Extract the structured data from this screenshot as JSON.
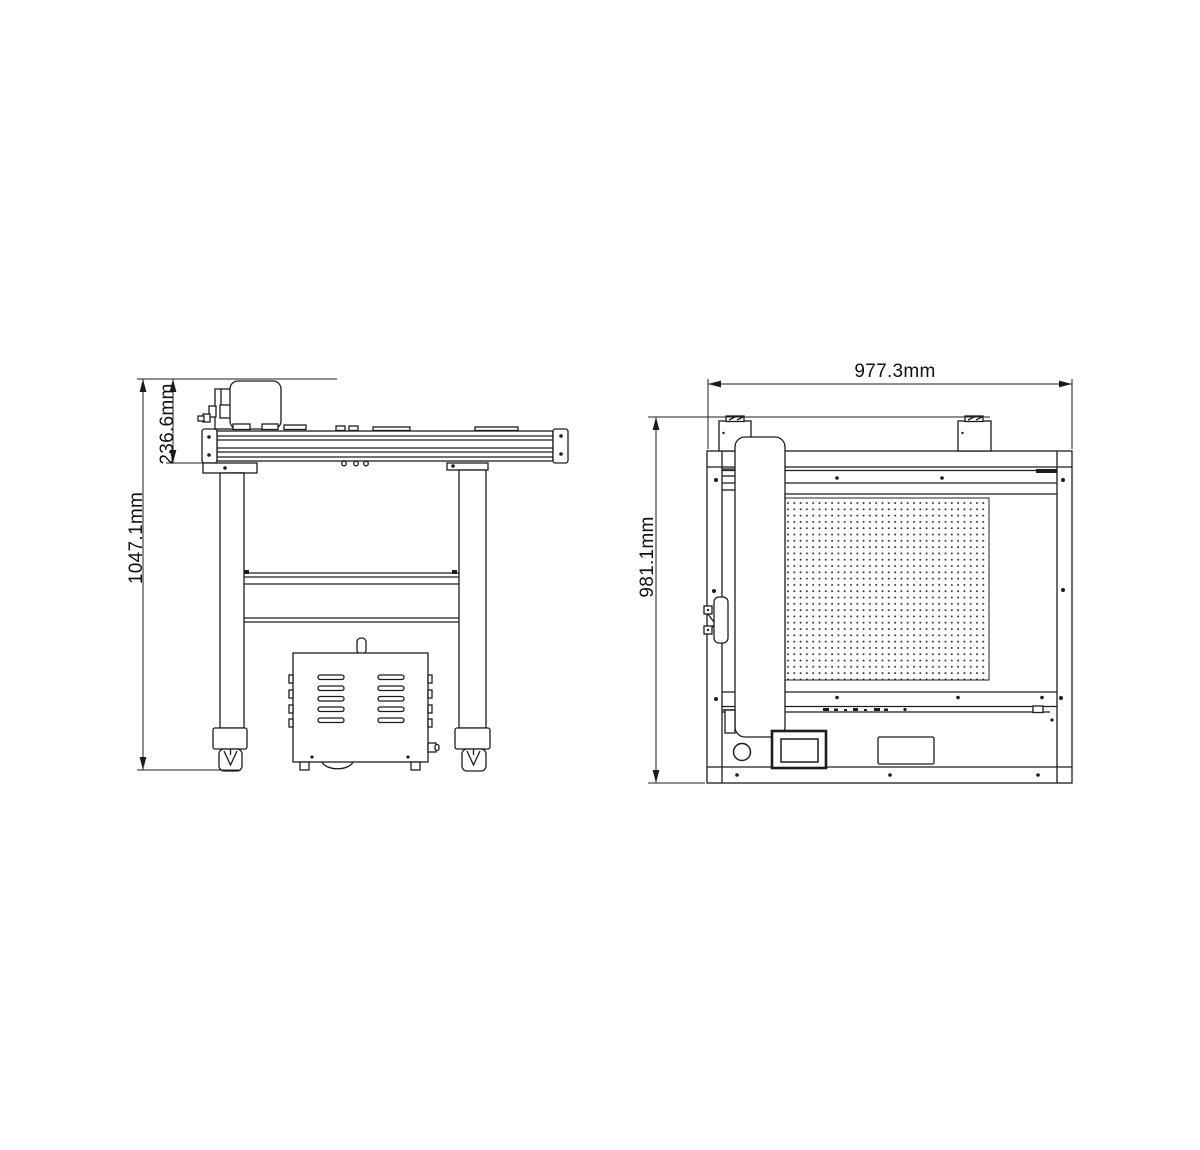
{
  "drawing": {
    "background_color": "#ffffff",
    "line_color": "#1c1c1c",
    "views": {
      "side_view": {
        "dimensions": {
          "overall_height": "1047.1mm",
          "table_top_height": "236.6mm"
        }
      },
      "top_view": {
        "dimensions": {
          "overall_width": "977.3mm",
          "overall_depth": "981.1mm"
        }
      }
    }
  }
}
